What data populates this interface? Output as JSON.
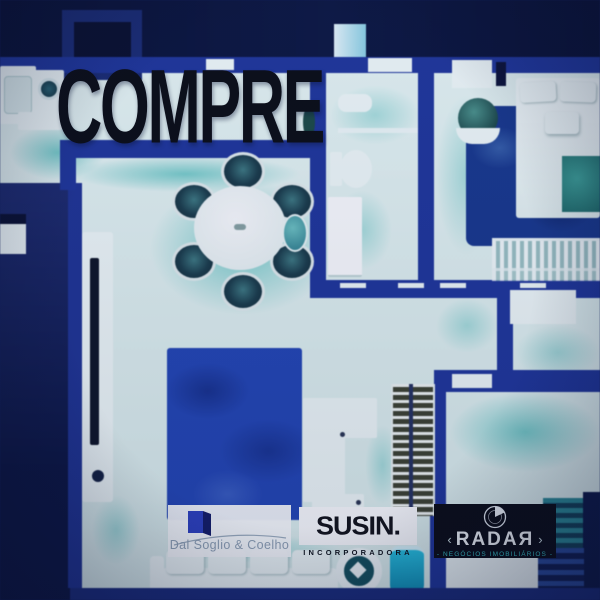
{
  "overlay": {
    "headline": "COMPRE"
  },
  "logos": {
    "dal_soglio": {
      "name": "Dal Soglio & Coelho",
      "icon": "book-icon",
      "bg_color": "#ffffff",
      "text_color": "#93a5b6",
      "accent_color": "#2e41c0"
    },
    "susin": {
      "name": "SUSIN.",
      "subtitle": "INCORPORADORA",
      "bg_color": "#ffffff",
      "text_color": "#121217"
    },
    "radar": {
      "name": "RADAЯ",
      "subtitle": "- NEGÓCIOS IMOBILIÁRIOS -",
      "icon": "radar-icon",
      "left_ornament": "‹",
      "right_ornament": "›",
      "bg_color": "#0b0b12",
      "text_color": "#f4f7f8",
      "subtitle_color": "#38c2c2"
    }
  },
  "palette": {
    "top_band": "#0a1134",
    "wall_blue": "#20369a",
    "floor_light": "#e9f7f4",
    "shadow_teal": "#48beb8",
    "living_rug_blue": "#2446b4",
    "bedroom_rug_blue": "#19388c",
    "exterior_navy": "#0c1540",
    "headline_color": "#0b0c12"
  }
}
